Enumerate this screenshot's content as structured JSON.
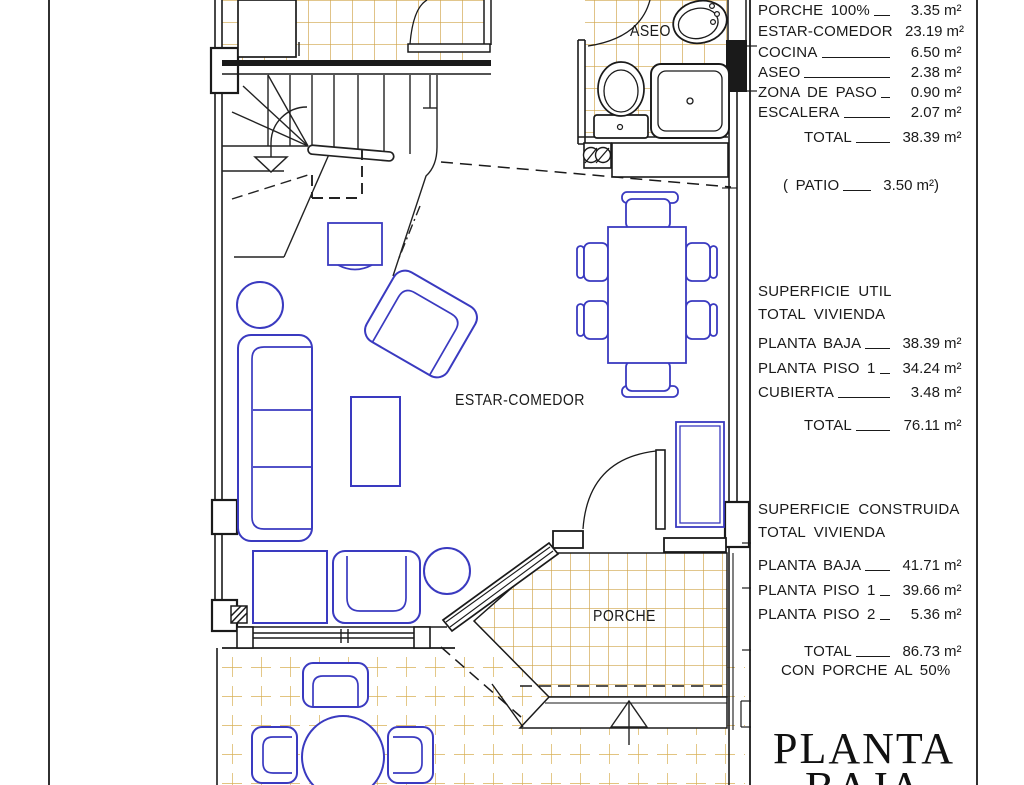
{
  "plan_labels": {
    "aseo": "ASEO",
    "estar_comedor": "ESTAR-COMEDOR",
    "porche": "PORCHE"
  },
  "areas_planta_baja": {
    "rows": [
      {
        "label": "PORCHE 100%",
        "value": "3.35",
        "unit": "m²"
      },
      {
        "label": "ESTAR-COMEDOR",
        "value": "23.19",
        "unit": "m²"
      },
      {
        "label": "COCINA",
        "value": "6.50",
        "unit": "m²"
      },
      {
        "label": "ASEO",
        "value": "2.38",
        "unit": "m²"
      },
      {
        "label": "ZONA DE PASO",
        "value": "0.90",
        "unit": "m²"
      },
      {
        "label": "ESCALERA",
        "value": "2.07",
        "unit": "m²"
      }
    ],
    "total": {
      "label": "TOTAL",
      "value": "38.39",
      "unit": "m²"
    },
    "patio": {
      "prefix": "( PATIO",
      "value": "3.50",
      "unit": "m²",
      "suffix": ")"
    }
  },
  "superficie_util": {
    "title": "SUPERFICIE UTIL",
    "subtitle": "TOTAL VIVIENDA",
    "rows": [
      {
        "label": "PLANTA BAJA",
        "value": "38.39",
        "unit": "m²"
      },
      {
        "label": "PLANTA PISO 1",
        "value": "34.24",
        "unit": "m²"
      },
      {
        "label": "CUBIERTA",
        "value": "3.48",
        "unit": "m²"
      }
    ],
    "total": {
      "label": "TOTAL",
      "value": "76.11",
      "unit": "m²"
    }
  },
  "superficie_construida": {
    "title": "SUPERFICIE CONSTRUIDA",
    "subtitle": "TOTAL VIVIENDA",
    "rows": [
      {
        "label": "PLANTA BAJA",
        "value": "41.71",
        "unit": "m²"
      },
      {
        "label": "PLANTA PISO 1",
        "value": "39.66",
        "unit": "m²"
      },
      {
        "label": "PLANTA PISO 2",
        "value": "5.36",
        "unit": "m²"
      }
    ],
    "total": {
      "label": "TOTAL",
      "value": "86.73",
      "unit": "m²"
    },
    "note": "CON PORCHE AL 50%"
  },
  "sheet_title": {
    "line1": "PLANTA",
    "line2": "BAJA"
  },
  "colors": {
    "furniture_blue": "#3a3ac0",
    "tile_gold": "#cfa348",
    "wall_black": "#1a1a1a"
  }
}
